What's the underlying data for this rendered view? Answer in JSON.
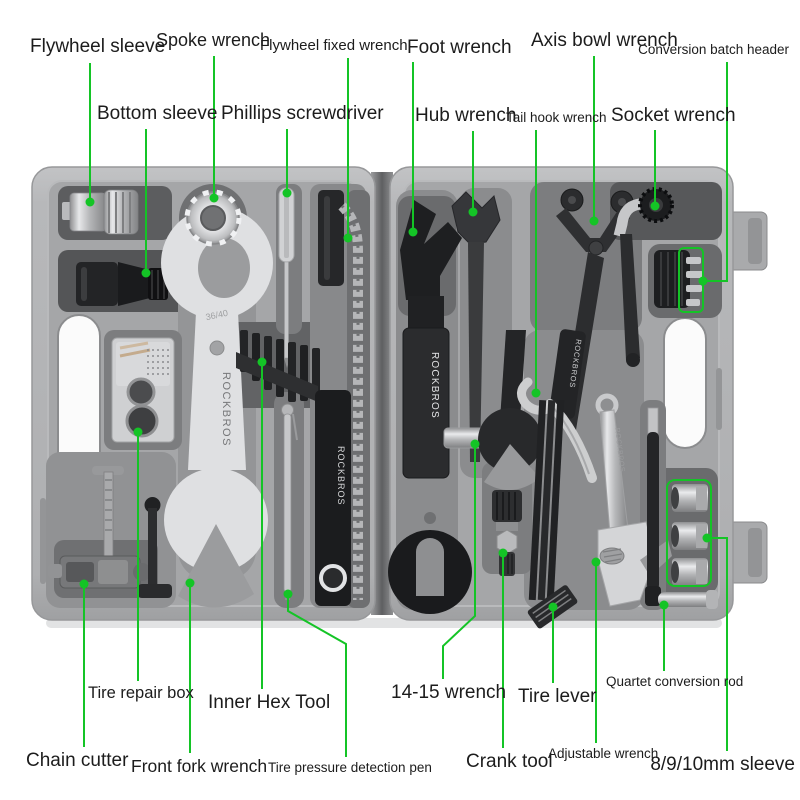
{
  "figure": {
    "type": "annotated-product-diagram",
    "subject": "bicycle repair tool kit in open carrying case",
    "accent_green": "#14c426",
    "case_color": "#b4b5b7",
    "tray_color": "#a5a6a8"
  },
  "markings": {
    "big_wrench_brand": "ROCKBROS",
    "big_wrench_size": "36/40",
    "hex_holder_brand": "ROCKBROS",
    "foot_wrench_brand": "ROCKBROS",
    "axis_wrench_brand": "ROCKBROS",
    "adjustable_wrench_brand": "ROCKBROS"
  },
  "labels": {
    "flywheel_sleeve": "Flywheel sleeve",
    "spoke_wrench": "Spoke wrench",
    "flywheel_fixed_wrench": "Flywheel fixed wrench",
    "foot_wrench": "Foot wrench",
    "axis_bowl_wrench": "Axis bowl wrench",
    "conversion_batch_header": "Conversion batch header",
    "bottom_sleeve": "Bottom sleeve",
    "phillips_screwdriver": "Phillips screwdriver",
    "hub_wrench": "Hub wrench",
    "tail_hook_wrench": "Tail hook wrench",
    "socket_wrench": "Socket wrench",
    "tire_repair_box": "Tire repair box",
    "inner_hex_tool": "Inner Hex Tool",
    "wrench_14_15": "14-15 wrench",
    "tire_lever": "Tire lever",
    "quartet_conversion_rod": "Quartet conversion rod",
    "chain_cutter": "Chain cutter",
    "front_fork_wrench": "Front fork wrench",
    "tire_pressure_detection_pen": "Tire pressure detection pen",
    "crank_tool": "Crank tool",
    "adjustable_wrench": "Adjustable wrench",
    "sleeve_8_9_10": "8/9/10mm sleeve"
  }
}
